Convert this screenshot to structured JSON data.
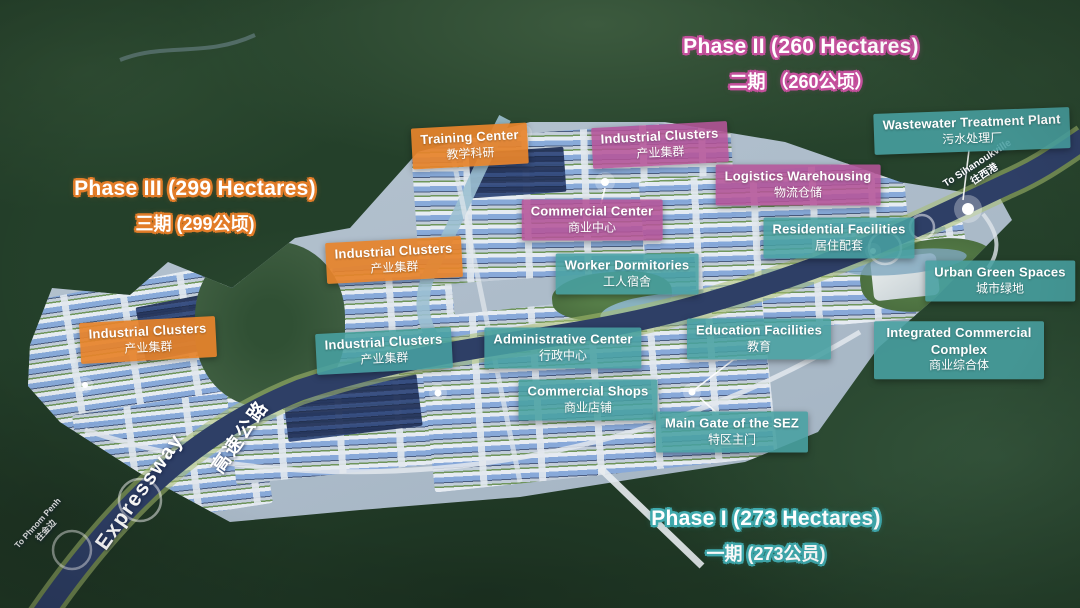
{
  "phases": {
    "phase2": {
      "en": "Phase II (260 Hectares)",
      "zh": "二期 （260公顷）",
      "outline_color": "#c4509c"
    },
    "phase3": {
      "en": "Phase III (299 Hectares)",
      "zh": "三期 (299公顷)",
      "outline_color": "#e27c28"
    },
    "phase1": {
      "en": "Phase I (273 Hectares)",
      "zh": "一期 (273公员)",
      "outline_color": "#3fa9ad"
    }
  },
  "labels": [
    {
      "name": "training-center",
      "en": "Training Center",
      "zh": "教学科研",
      "type": "orange",
      "x": 470,
      "y": 146,
      "rot": -3
    },
    {
      "name": "industrial-clusters-north",
      "en": "Industrial Clusters",
      "zh": "产业集群",
      "type": "pink",
      "x": 660,
      "y": 145,
      "rot": -3
    },
    {
      "name": "wastewater-treatment-plant",
      "en": "Wastewater Treatment Plant",
      "zh": "污水处理厂",
      "type": "teal",
      "x": 972,
      "y": 131,
      "rot": -2
    },
    {
      "name": "logistics-warehousing",
      "en": "Logistics Warehousing",
      "zh": "物流仓储",
      "type": "pink",
      "x": 798,
      "y": 185,
      "rot": 0
    },
    {
      "name": "commercial-center",
      "en": "Commercial Center",
      "zh": "商业中心",
      "type": "pink",
      "x": 592,
      "y": 220,
      "rot": 0
    },
    {
      "name": "residential-facilities",
      "en": "Residential Facilities",
      "zh": "居住配套",
      "type": "teal",
      "x": 839,
      "y": 238,
      "rot": 0
    },
    {
      "name": "worker-dormitories",
      "en": "Worker Dormitories",
      "zh": "工人宿舍",
      "type": "teal",
      "x": 627,
      "y": 274,
      "rot": 0
    },
    {
      "name": "urban-green-spaces",
      "en": "Urban Green Spaces",
      "zh": "城市绿地",
      "type": "teal",
      "x": 1000,
      "y": 281,
      "rot": 0
    },
    {
      "name": "industrial-clusters-central",
      "en": "Industrial Clusters",
      "zh": "产业集群",
      "type": "orange",
      "x": 394,
      "y": 260,
      "rot": -3
    },
    {
      "name": "industrial-clusters-west",
      "en": "Industrial Clusters",
      "zh": "产业集群",
      "type": "orange",
      "x": 148,
      "y": 340,
      "rot": -3
    },
    {
      "name": "industrial-clusters-south",
      "en": "Industrial Clusters",
      "zh": "产业集群",
      "type": "teal",
      "x": 384,
      "y": 351,
      "rot": -3
    },
    {
      "name": "administrative-center",
      "en": "Administrative Center",
      "zh": "行政中心",
      "type": "teal",
      "x": 563,
      "y": 348,
      "rot": 0
    },
    {
      "name": "education-facilities",
      "en": "Education Facilities",
      "zh": "教育",
      "type": "teal",
      "x": 759,
      "y": 339,
      "rot": 0
    },
    {
      "name": "integrated-commercial-complex",
      "en": "Integrated Commercial Complex",
      "zh": "商业综合体",
      "type": "teal",
      "x": 959,
      "y": 350,
      "rot": 0,
      "w": 152
    },
    {
      "name": "commercial-shops",
      "en": "Commercial Shops",
      "zh": "商业店铺",
      "type": "teal",
      "x": 588,
      "y": 400,
      "rot": 0
    },
    {
      "name": "main-gate-of-the-sez",
      "en": "Main Gate of the SEZ",
      "zh": "特区主门",
      "type": "teal",
      "x": 732,
      "y": 432,
      "rot": 0
    }
  ],
  "roads": {
    "expressway_en": "Expressway",
    "expressway_zh": "高速公路",
    "to_sihanoukville_en": "To Sihanoukville",
    "to_sihanoukville_zh": "往西港",
    "to_phnom_penh_en": "To Phnom Penh",
    "to_phnom_penh_zh": "往金边"
  },
  "colors": {
    "label_orange": "#e6832b",
    "label_pink": "#b55498",
    "label_teal": "#48a0a2",
    "expressway_road": "#2e3f66",
    "park_ground": "#aebdcb",
    "forest": "#24402a"
  }
}
